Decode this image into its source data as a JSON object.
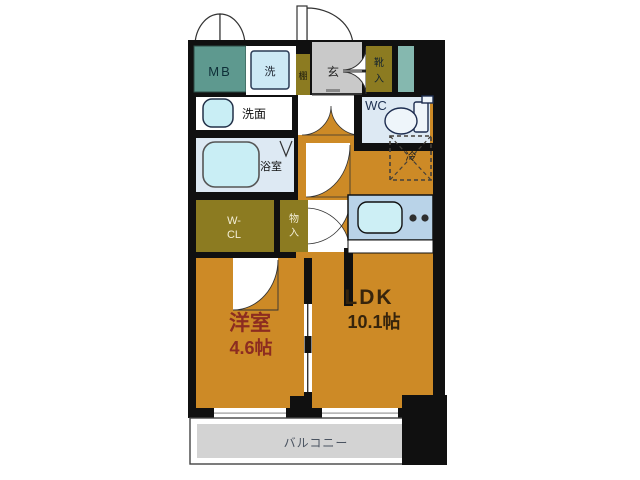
{
  "floorplan": {
    "type": "apartment-floor-plan",
    "labels": {
      "mb": "MB",
      "laundry": "洗",
      "shelf": "棚",
      "entrance": "玄",
      "shoe_1": "靴",
      "shoe_2": "入",
      "washroom": "洗面",
      "wc": "WC",
      "bathroom": "浴室",
      "wcl_line1": "W-",
      "wcl_line2": "CL",
      "storage_1": "物",
      "storage_2": "入",
      "fridge": "冷",
      "bedroom_name": "洋室",
      "bedroom_size": "4.6帖",
      "ldk_name": "LDK",
      "ldk_size": "10.1帖",
      "balcony": "バルコニー"
    },
    "colors": {
      "floor": "#cd8a26",
      "closet": "#8c7b21",
      "meter_box": "#5e998f",
      "teal_strip": "#85b8af",
      "genkan_gray": "#c9c9c9",
      "balcony_gray": "#d3d3d3",
      "wet_room_blue": "#dde9f3",
      "fixture_cyan": "#c9eef5",
      "counter_blue": "#b9d3e8",
      "wall": "#101010",
      "bedroom_text": "#8c2c20",
      "ldk_text": "#36240c",
      "balcony_text": "#4a5360"
    }
  }
}
